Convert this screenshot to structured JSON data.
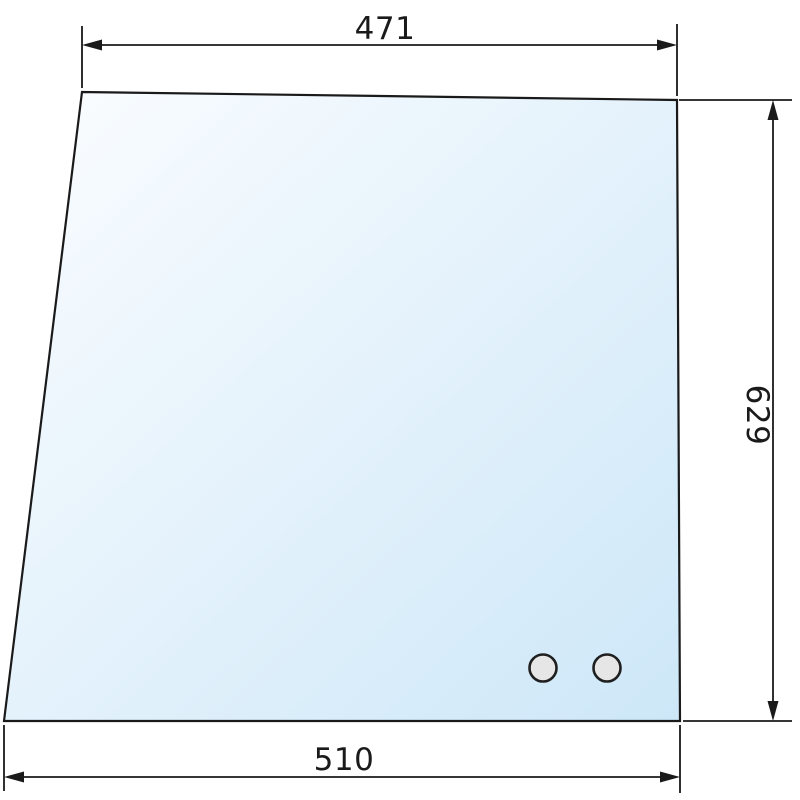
{
  "diagram": {
    "kind": "technical-drawing",
    "subject": "glass-panel-with-mounting-holes",
    "dimensions": {
      "top_width": "471",
      "right_height": "629",
      "bottom_width": "510"
    },
    "holes": {
      "count": 2,
      "fill": "#e6e6e6",
      "stroke": "#1f1f1f"
    },
    "colors": {
      "background": "#ffffff",
      "line": "#1a1a1a",
      "glass_gradient_start": "#fbfdff",
      "glass_gradient_end": "#cde7f8"
    }
  }
}
